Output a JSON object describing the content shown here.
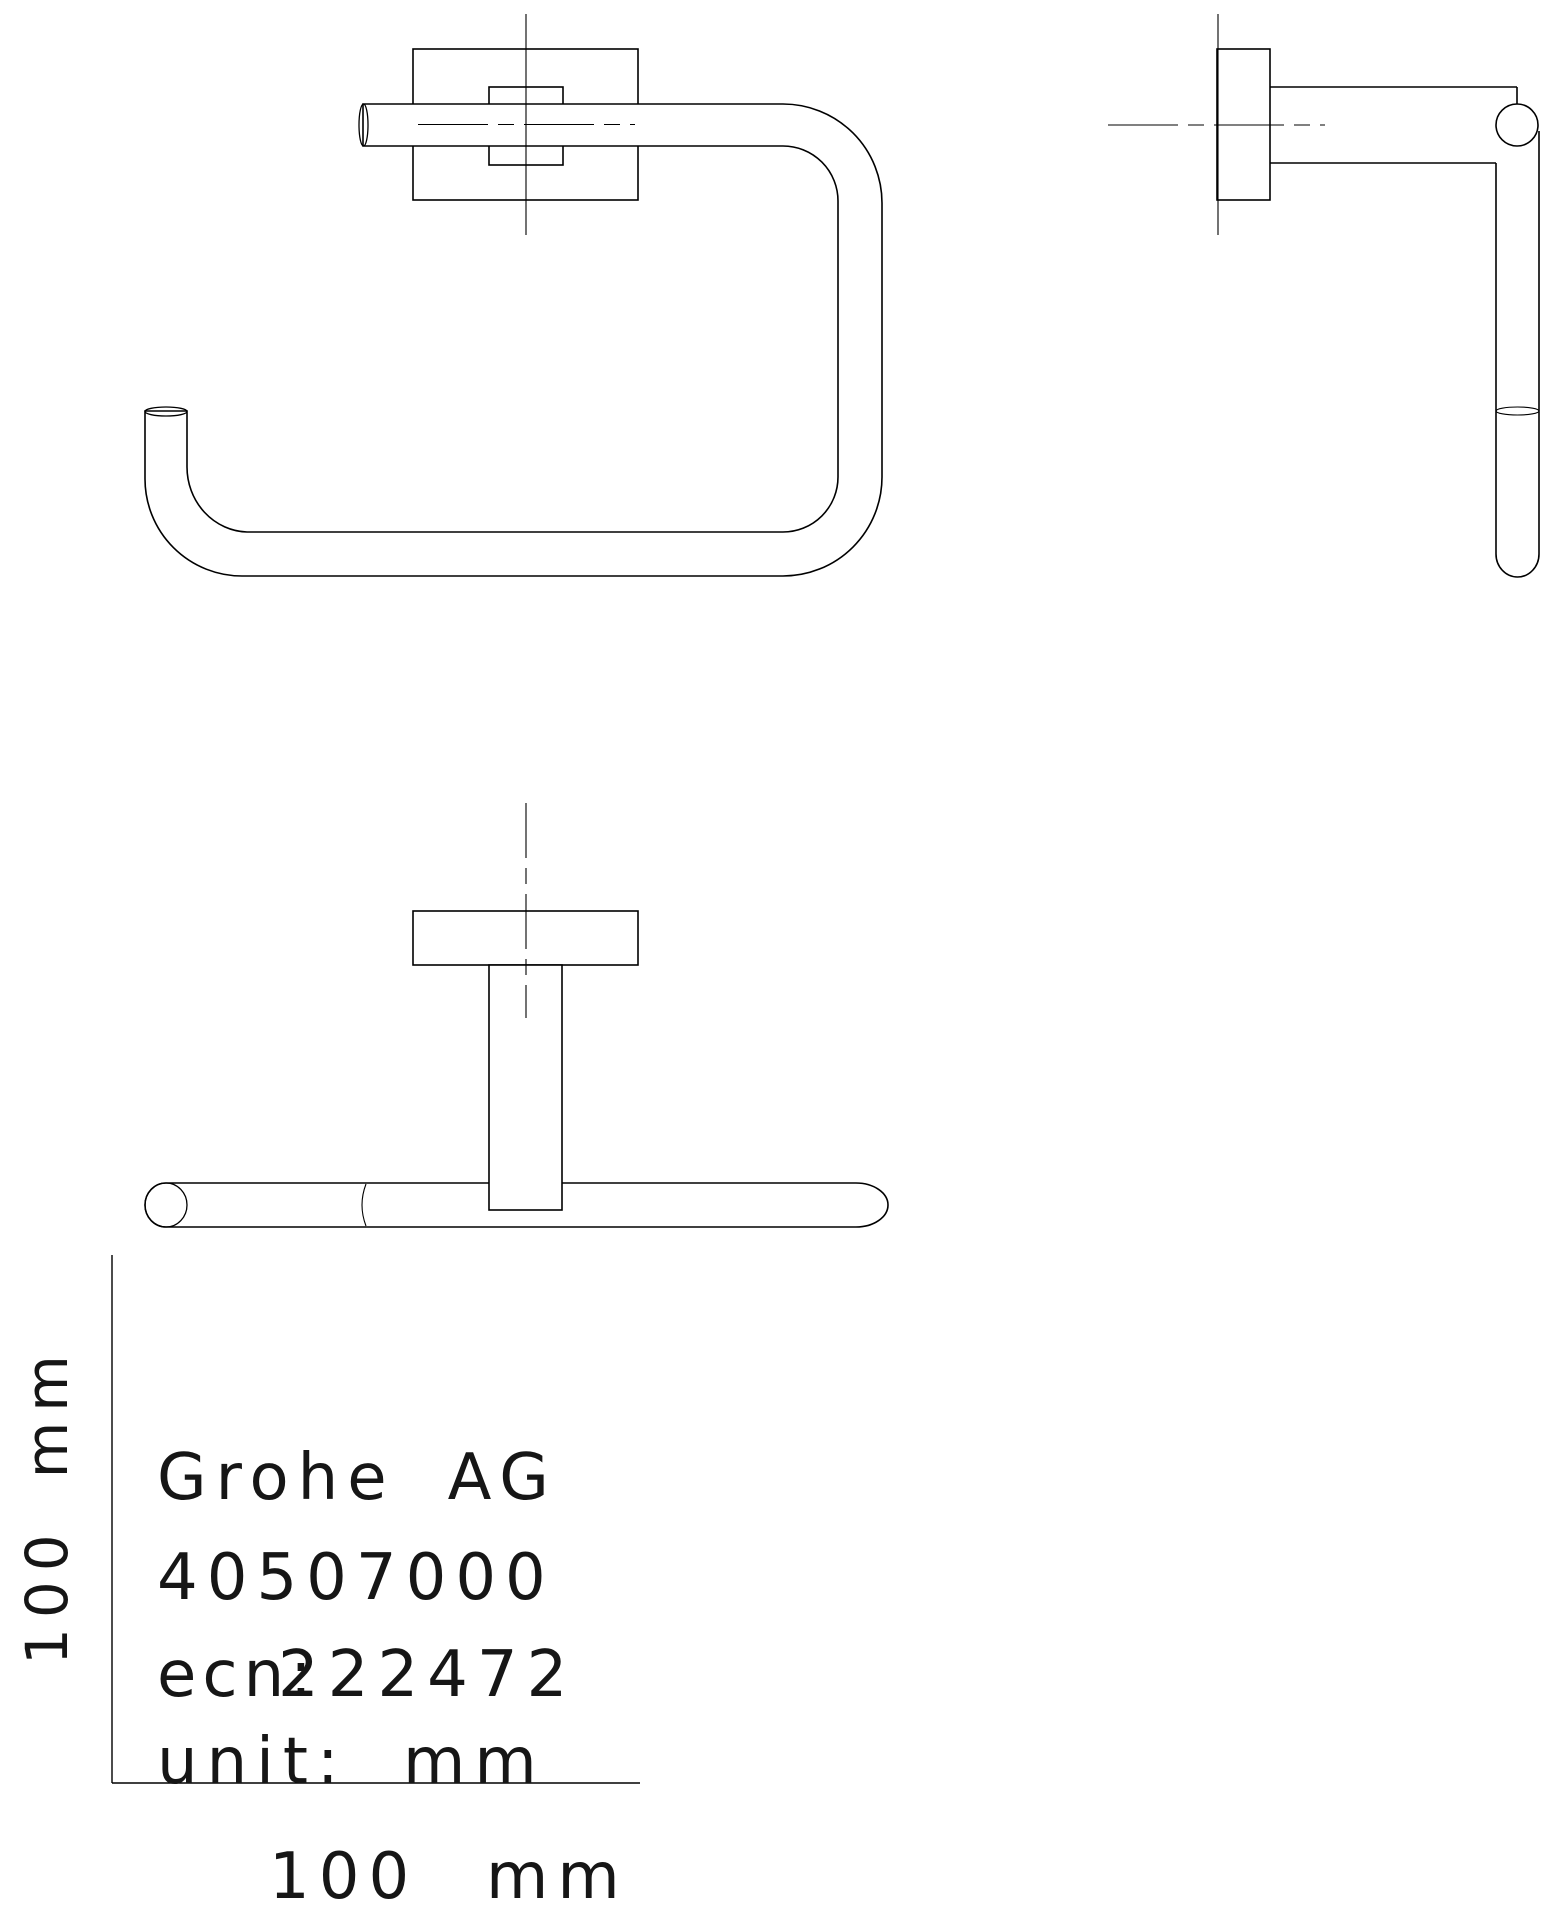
{
  "meta": {
    "background_color": "#ffffff",
    "line_color": "#000000",
    "drawing_type": "orthographic projection, 3 views, toilet paper holder"
  },
  "title_block": {
    "company_name": "Grohe",
    "company_suffix": "AG",
    "product_number": "40507000",
    "ecn_label": "ecn:",
    "ecn_value": "222472",
    "unit_label": "unit:",
    "unit_value": "mm"
  },
  "dimensions": {
    "horizontal": {
      "value": "100",
      "unit": "mm"
    },
    "vertical": {
      "value": "100",
      "unit": "mm"
    }
  }
}
